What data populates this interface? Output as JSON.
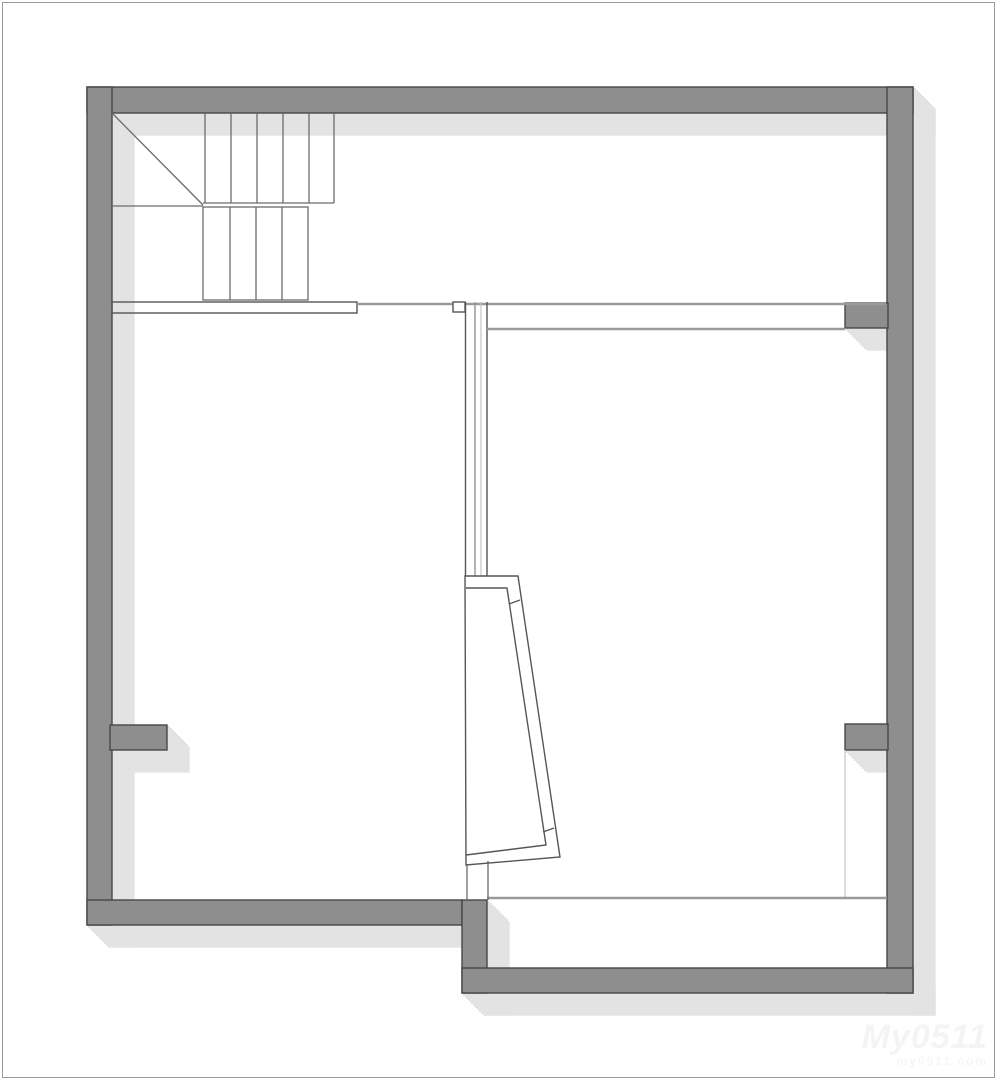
{
  "meta": {
    "type": "architectural floor plan",
    "description": "Second-floor plan drawing: U-shaped staircase in the top-left corner, a large room on the left, a large room on the right separated by a double-line partition with an angled doorway screen, a lower-right room, and wall stubs forming door openings."
  },
  "colors": {
    "wall_fill": "#8e8e8e",
    "wall_stroke": "#474747",
    "shadow": "#e3e3e3",
    "line_dark": "#6b6b6b",
    "line_outline": "#565656",
    "line_mid": "#9a9a9a",
    "line_light": "#c6c6c6",
    "border_line": "#9b9b9b",
    "watermark": "#f4f4f4",
    "watermark_sub": "#f6f6f6"
  },
  "plan": {
    "stair_upper_treads": 6,
    "stair_lower_treads": 5,
    "elements": [
      "exterior walls",
      "staircase with landing and break line",
      "interior partition wall",
      "angled door screen",
      "door opening stubs",
      "closet lines bottom-right"
    ]
  },
  "watermark": {
    "brand": "My0511",
    "sub": "my0511.com"
  }
}
